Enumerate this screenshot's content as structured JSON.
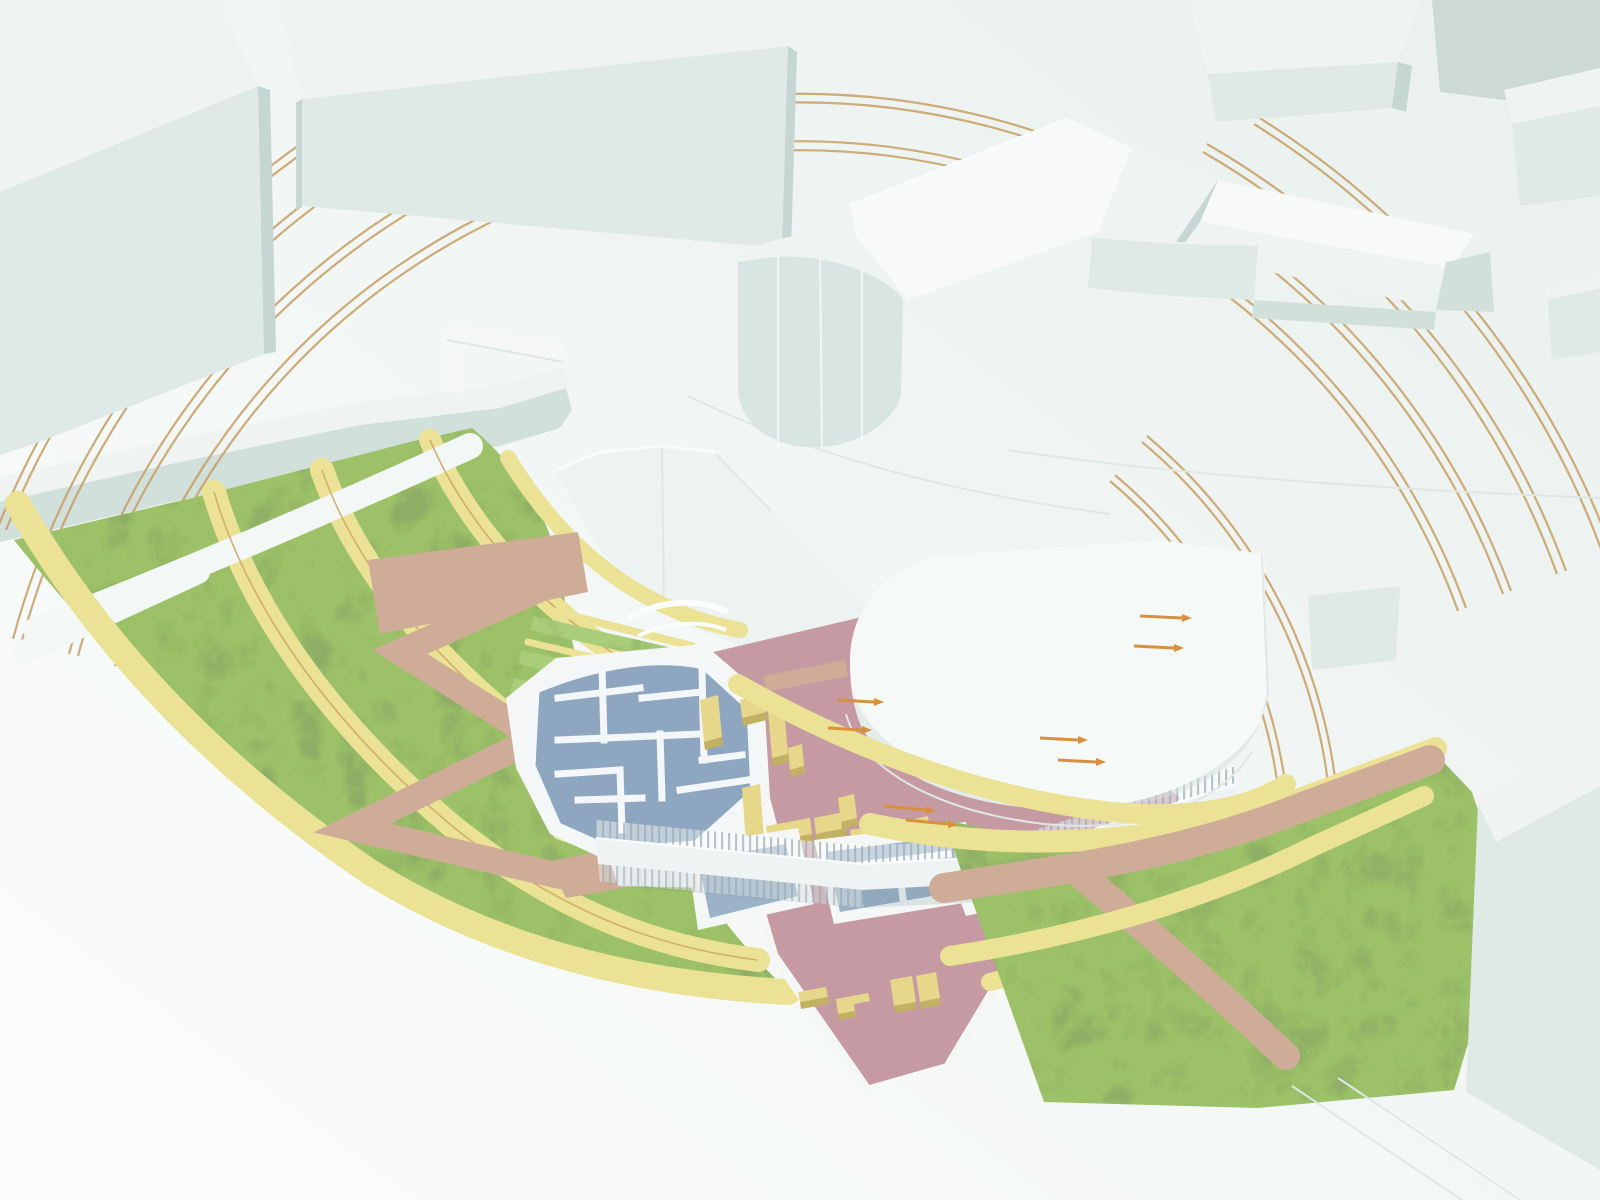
{
  "scene": {
    "label": "3D architectural site massing model: white city blocks and church around a terraced crescent park with archaeological excavation, sunken road, pedestrian bridge and guide arcs",
    "elements": {
      "buildings": [
        "city-block-west",
        "city-block-north",
        "church-with-apse",
        "gabled-hall-east",
        "round-hall",
        "north-east-block",
        "corner-block",
        "south-east-block"
      ],
      "landscape": [
        "terraced-crescent-park",
        "upper-plaza-wall",
        "excavation-cliff",
        "zigzag-ramp",
        "excavation-site",
        "central-plaza",
        "sunken-road",
        "pedestrian-bridge",
        "water-pools",
        "east-lawn",
        "lawn-paths"
      ],
      "annotations": [
        "concentric-guide-arcs",
        "flow-arrows",
        "plot-lines"
      ]
    }
  },
  "colors": {
    "bg": "#f3f7f5",
    "bg_top": "#e9f0ee",
    "roof": "#eff4f2",
    "roof_bright": "#f7faf9",
    "face_light": "#dfe9e6",
    "face_mid": "#d2e0dc",
    "face_dark": "#c6d6d2",
    "face_gray": "#ccd9d5",
    "face_apse": "#d9e5e2",
    "cliff": "#edf3f1",
    "wall_white": "#f4f7f6",
    "bridge": "#eef3f4",
    "round_white": "#f5f9f8",
    "excavation": "#8ea6bf",
    "pool": "#9cb2c8",
    "ruin": "#f4f7f9",
    "plaza": "#c59aa3",
    "path_tan": "#cfac98",
    "band": "#ebe295",
    "band_edge": "#cfa76a",
    "block_top": "#e7d78b",
    "block_side": "#c3b163",
    "grass": "#9cc167",
    "grass_light": "#a9cd79",
    "arc": "#c69e62",
    "arrow": "#d8903f",
    "ground_line": "#dfe8e5",
    "rail_line": "#a5b4ba",
    "shadow": "rgba(96,116,128,0.16)"
  }
}
